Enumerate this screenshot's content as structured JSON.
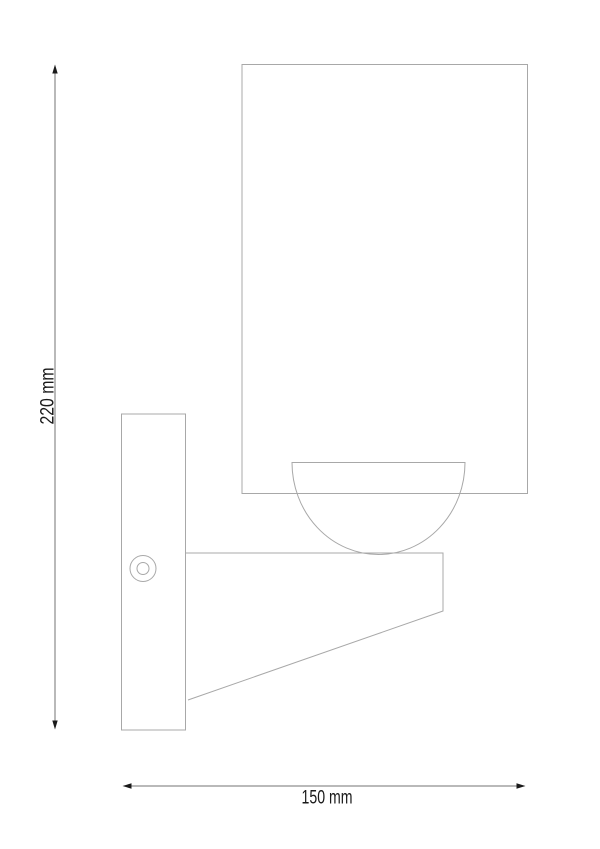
{
  "drawing": {
    "title": "Wall lamp technical side-view line drawing",
    "view": "side elevation",
    "parts": {
      "lampshade": "cylindrical shade (rectangle in side view)",
      "diffuser": "half-dome diffuser under shade",
      "wall_plate": "wall mounting plate",
      "screw": "mounting screw head",
      "bracket_arm": "tapered support arm"
    },
    "dimension_height": {
      "label": "220 mm",
      "value": 220,
      "unit": "mm",
      "orientation": "vertical"
    },
    "dimension_width": {
      "label": "150 mm",
      "value": 150,
      "unit": "mm",
      "orientation": "horizontal"
    },
    "colors": {
      "background": "#ffffff",
      "object_line": "#a8a8a8",
      "dimension_line": "#737373",
      "arrowhead": "#1a1a1a",
      "label_text": "#1a1a1a"
    }
  }
}
